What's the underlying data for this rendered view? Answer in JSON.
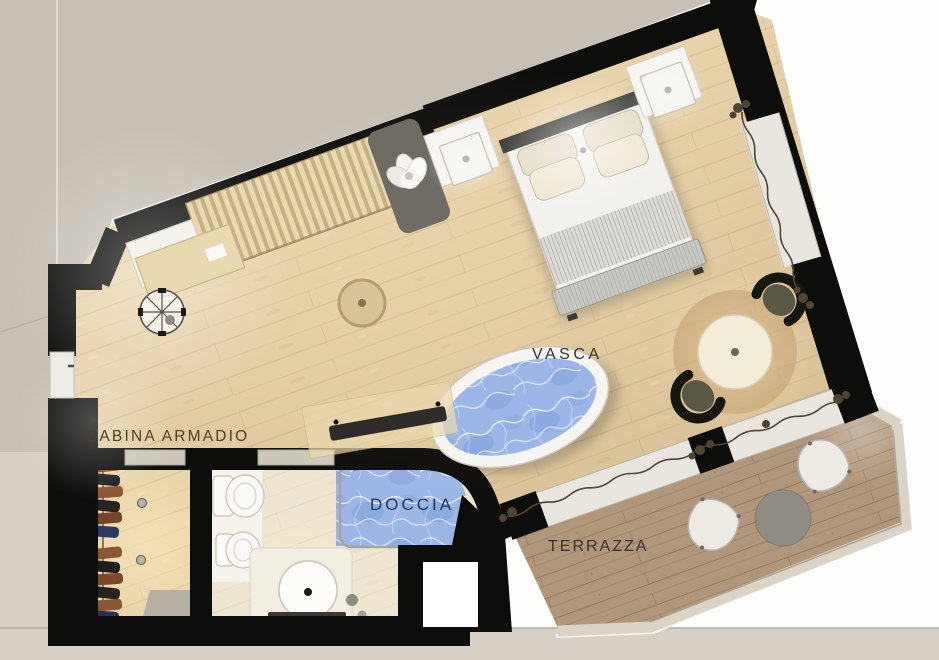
{
  "plan": {
    "labels": {
      "closet": "CABINA ARMADIO",
      "bathtub": "VASCA",
      "shower": "DOCCIA",
      "terrace": "TERRAZZA"
    },
    "colors": {
      "wall": "#0d0d0c",
      "room_floor": "#e2cba1",
      "terrace_floor": "#b0967a",
      "bathroom_floor": "#efe6d1",
      "closet_floor": "#e9d6ab",
      "water": "#9cb7e7",
      "water_deep": "#7e9fd8",
      "glazing": "#e9e6df",
      "exterior": "#c6c0b5",
      "ground": "#d6d1c4",
      "railing": "#d9d4c6",
      "label_brown": "#503e27",
      "label_dark": "#37322c",
      "label_navy": "#24365c",
      "curtain": "#4f4535"
    }
  }
}
